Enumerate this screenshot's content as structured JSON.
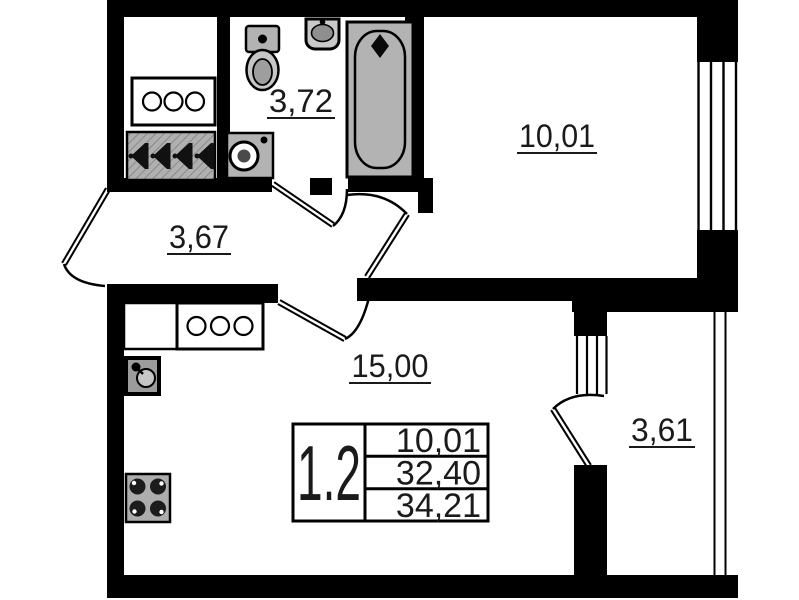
{
  "plan": {
    "type": "apartment-floor-plan",
    "areas": {
      "bathroom": "3,72",
      "bedroom": "10,01",
      "hallway": "3,67",
      "living_kitchen": "15,00",
      "balcony": "3,61"
    },
    "info_table": {
      "unit": "1.2",
      "rows": [
        "10,01",
        "32,40",
        "34,21"
      ]
    },
    "fixtures": [
      "wardrobe",
      "dresser",
      "coat-rack",
      "toilet",
      "washbasin",
      "washing-machine",
      "bathtub",
      "kitchen-counter",
      "kitchen-cabinet",
      "kitchen-sink",
      "stove",
      "window",
      "balcony-railing"
    ],
    "colors": {
      "wall": "#000000",
      "fixture_gray": "#b3b3b3",
      "background": "#ffffff",
      "text": "#1a1a1a"
    }
  }
}
